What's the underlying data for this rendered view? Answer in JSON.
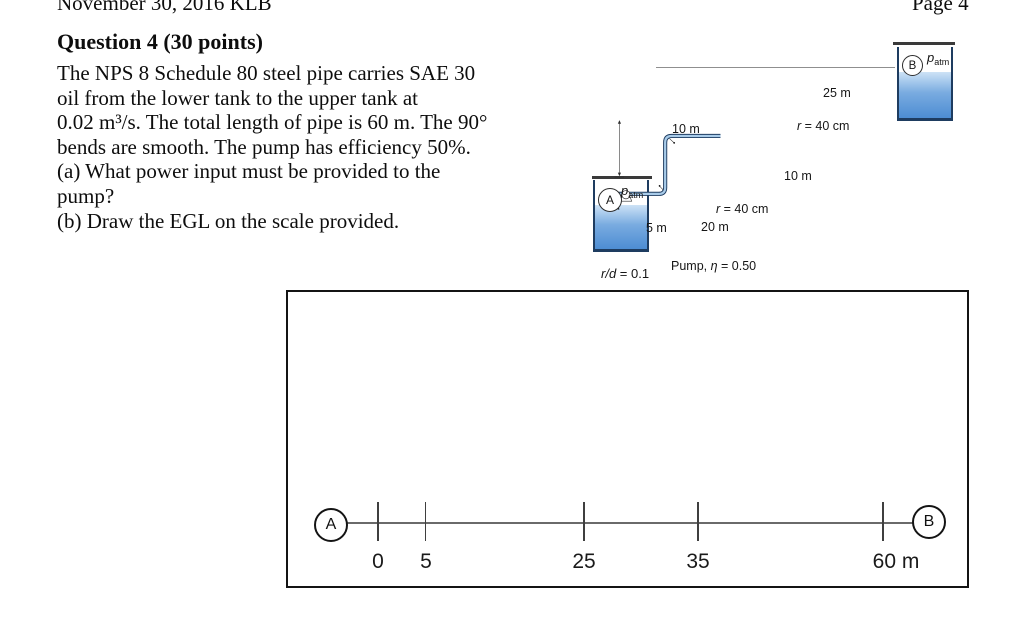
{
  "header": {
    "left": "November 30, 2016 KLB",
    "right": "Page 4"
  },
  "question": {
    "title": "Question 4 (30 points)",
    "body": "The NPS 8 Schedule 80 steel pipe carries SAE 30\noil from the lower tank to the upper tank at\n0.02 m³/s. The total length of pipe is 60 m. The 90°\nbends are smooth. The pump has efficiency 50%.\n(a) What power input must be provided to the\npump?\n(b) Draw the EGL on the scale provided."
  },
  "diagram": {
    "tank_a": {
      "label": "A"
    },
    "tank_b": {
      "label": "B"
    },
    "pressure": {
      "sym": "p",
      "sub": "atm"
    },
    "dims": {
      "height": "10 m",
      "top_run": "25 m",
      "riser": "10 m",
      "suction": "5 m",
      "discharge": "20 m"
    },
    "bend": {
      "sym": "r",
      "val": " = 40 cm"
    },
    "entry": {
      "sym": "r/d",
      "val": " = 0.1"
    },
    "pump": {
      "pre": "Pump, ",
      "sym": "η",
      "val": " = 0.50"
    },
    "colors": {
      "water_top": "#cde2f6",
      "water_bottom": "#4d8dd3",
      "pipe_fill": "#a8cbe9",
      "pipe_stroke": "#1e3c60"
    }
  },
  "scale": {
    "start": "A",
    "end": "B",
    "ticks": [
      "0",
      "5",
      "25",
      "35",
      "60 m"
    ]
  }
}
